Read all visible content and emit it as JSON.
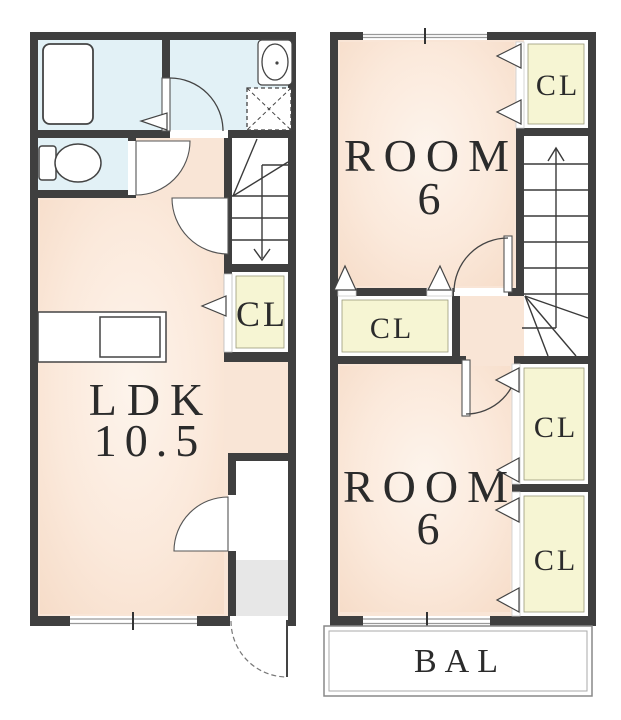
{
  "colors": {
    "wall": "#3f3f3f",
    "room_pink": "#f9e5d6",
    "wet_blue": "#e2f1f6",
    "closet_yellow": "#f6f5d3",
    "entry_gray": "#e7e7e7",
    "balcony_white": "#ffffff",
    "line": "#3a3a3a",
    "text": "#2b2b2b"
  },
  "floor1": {
    "ldk": {
      "label": "LDK",
      "area": "10.5"
    },
    "closet": {
      "label": "CL"
    }
  },
  "floor2": {
    "room_top": {
      "label": "ROOM",
      "area": "6"
    },
    "room_bottom": {
      "label": "ROOM",
      "area": "6"
    },
    "closet_top_right": {
      "label": "CL"
    },
    "closet_middle": {
      "label": "CL"
    },
    "closet_right_upper": {
      "label": "CL"
    },
    "closet_right_lower": {
      "label": "CL"
    },
    "balcony": {
      "label": "BAL"
    }
  }
}
